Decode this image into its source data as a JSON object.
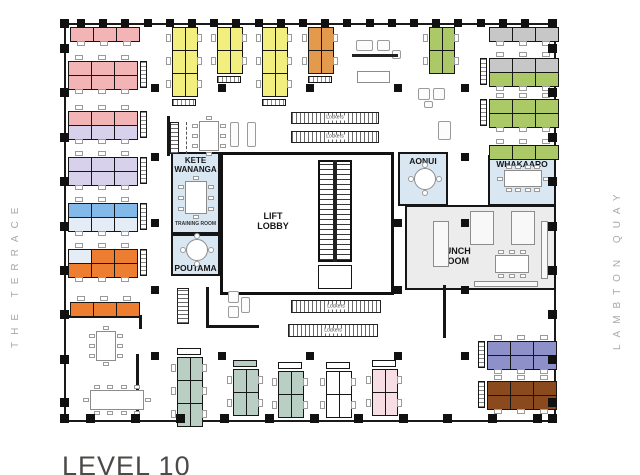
{
  "title": "LEVEL 10",
  "streets": {
    "left": "THE TERRACE",
    "right": "LAMBTON QUAY"
  },
  "rooms": {
    "kete_wananga": "KETE WANANGA",
    "training_room": "TRAINING ROOM",
    "poutama": "POUTAMA",
    "lift_lobby": "LIFT LOBBY",
    "aonui": "AONUI",
    "whakaaro": "WHAKAARO",
    "lunch_room": "LUNCH ROOM"
  },
  "labels": {
    "lockers": "Lockers"
  },
  "palette": {
    "pink": "#f2b4b4",
    "lavender": "#d8d1ec",
    "blue": "#82b9e8",
    "pale": "#e4edf5",
    "orange": "#ed7d31",
    "yellow": "#f3ef7e",
    "amber": "#e39a4d",
    "green": "#abc966",
    "gray": "#c7c7c7",
    "sage": "#b9cfc4",
    "white": "#ffffff",
    "pinkpale": "#f6dee4",
    "purple": "#8e90c9",
    "brown": "#8a4a1e",
    "room_blue": "#d9e7f3",
    "lunch_gray": "#ececec",
    "wall": "#1a1a1a"
  }
}
